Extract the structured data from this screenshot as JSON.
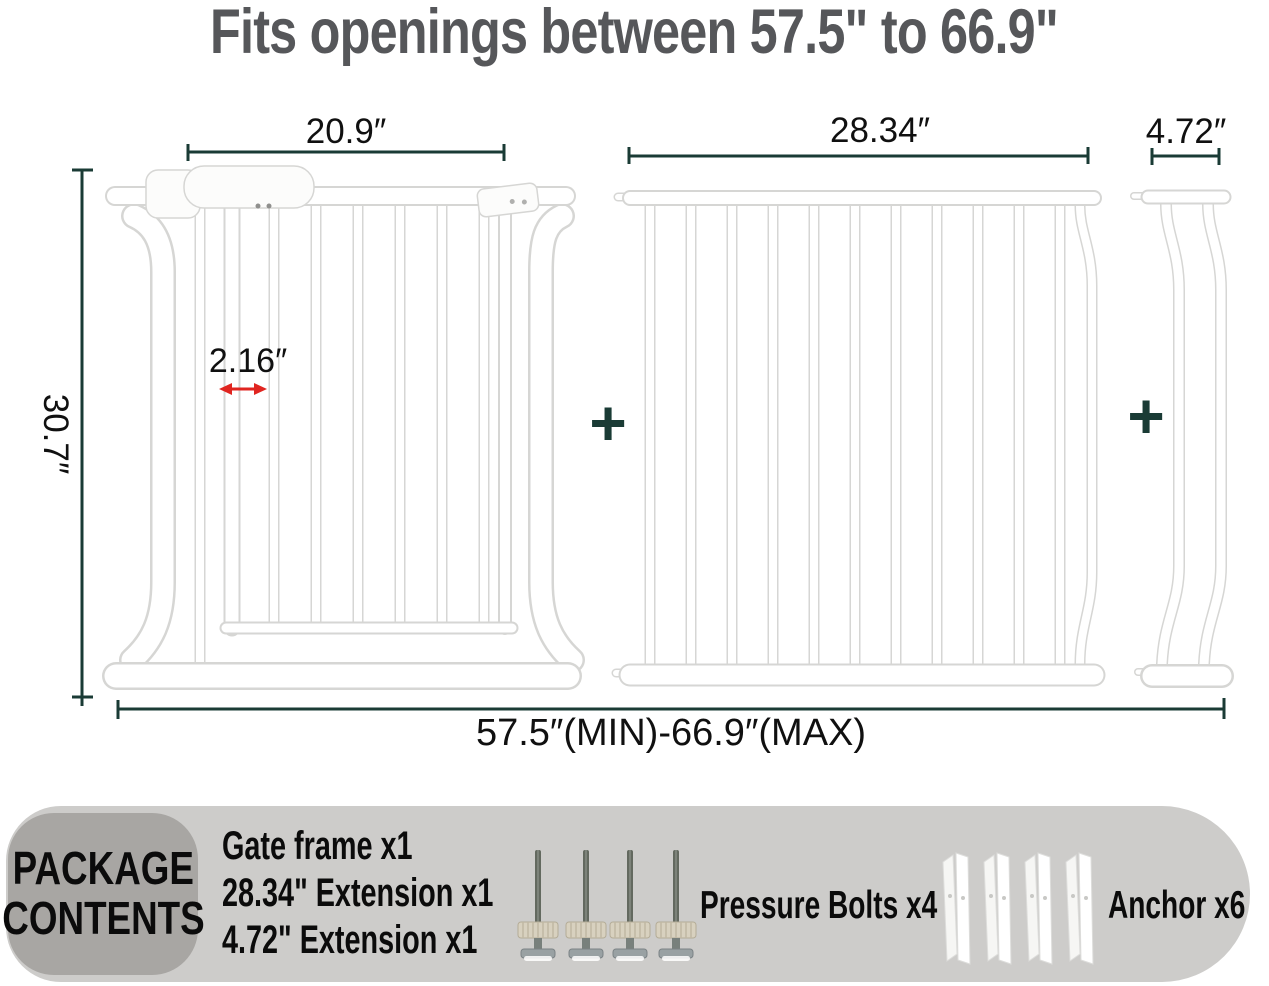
{
  "title": "Fits openings between 57.5\" to 66.9\"",
  "diagram": {
    "gate_width_label": "20.9″",
    "extension_width_label": "28.34″",
    "small_extension_width_label": "4.72″",
    "height_label": "30.7″",
    "bar_gap_label": "2.16″",
    "range_label": "57.5″(MIN)-66.9″(MAX)",
    "plus": "+"
  },
  "package": {
    "badge_line1": "PACKAGE",
    "badge_line2": "CONTENTS",
    "items": [
      "Gate frame x1",
      "28.34\" Extension x1",
      "4.72\" Extension x1"
    ],
    "pressure_bolts_label": "Pressure Bolts x4",
    "anchor_label": "Anchor x6"
  },
  "colors": {
    "dim": "#1a3b35",
    "red": "#e02520",
    "title": "#56575a",
    "ink": "#101010",
    "panel-bg": "#cdccca",
    "badge-bg": "#a8a6a3",
    "tube-edge": "#d6d6d4"
  }
}
